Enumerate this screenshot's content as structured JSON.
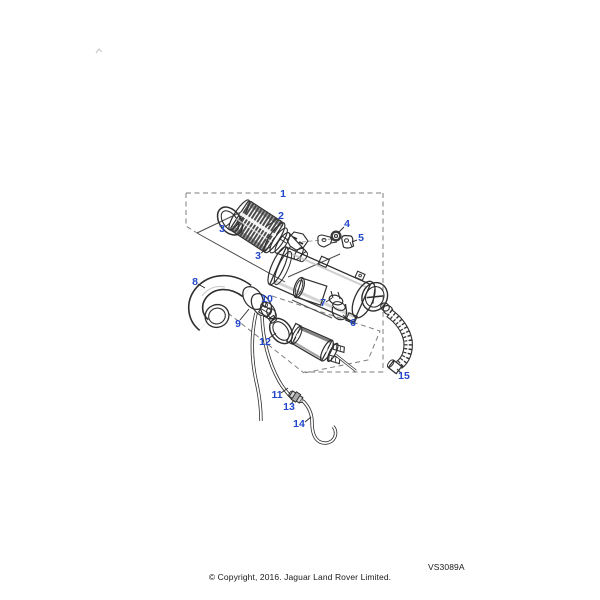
{
  "page": {
    "background": "#ffffff"
  },
  "diagram": {
    "code": "VS3089A",
    "copyright": "© Copyright, 2016. Jaguar Land Rover Limited.",
    "accent_color": "#2247cb",
    "line_color": "#303030",
    "callouts": [
      {
        "label": "1",
        "x": 283,
        "y": 197
      },
      {
        "label": "2",
        "x": 281,
        "y": 219
      },
      {
        "label": "3",
        "x": 222,
        "y": 232
      },
      {
        "label": "3",
        "x": 258,
        "y": 259
      },
      {
        "label": "4",
        "x": 347,
        "y": 227
      },
      {
        "label": "5",
        "x": 361,
        "y": 241
      },
      {
        "label": "6",
        "x": 353,
        "y": 326
      },
      {
        "label": "7",
        "x": 323,
        "y": 306
      },
      {
        "label": "8",
        "x": 195,
        "y": 285
      },
      {
        "label": "9",
        "x": 238,
        "y": 327
      },
      {
        "label": "10",
        "x": 267,
        "y": 302
      },
      {
        "label": "11",
        "x": 277,
        "y": 398
      },
      {
        "label": "12",
        "x": 265,
        "y": 345
      },
      {
        "label": "13",
        "x": 289,
        "y": 410
      },
      {
        "label": "14",
        "x": 299,
        "y": 427
      },
      {
        "label": "15",
        "x": 404,
        "y": 379
      }
    ]
  }
}
